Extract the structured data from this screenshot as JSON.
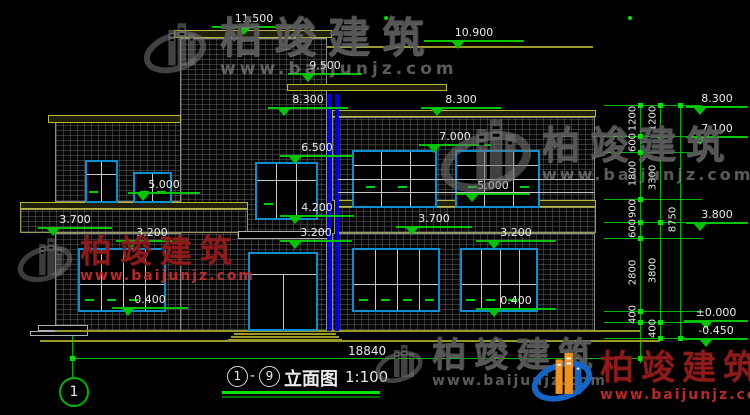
{
  "colors": {
    "background": "#000000",
    "dim_green": "#00c400",
    "frame_cyan": "#0b8fd0",
    "slab_olive": "#b8b838",
    "column_blue": "#0000e6",
    "watermark_grey": "#8a8a8a",
    "watermark_red": "#c02020",
    "text_white": "#ececec"
  },
  "watermark": {
    "brand": "柏竣建筑",
    "url": "www.baijunjz.com"
  },
  "elevations": {
    "v11500": "11.500",
    "v10900": "10.900",
    "v9500": "9.500",
    "v8300": "8.300",
    "v7100": "7.100",
    "v7000": "7.000",
    "v6500": "6.500",
    "v5000": "5.000",
    "v4200": "4.200",
    "v3800": "3.800",
    "v3700": "3.700",
    "v3200": "3.200",
    "v0400": "0.400",
    "v0000": "±0.000",
    "vm0450": "-0.450"
  },
  "dims": {
    "overall_width": "18840",
    "right_total": "8750",
    "chain_inner": [
      "1200",
      "600",
      "1800",
      "900",
      "600",
      "2800",
      "400"
    ],
    "chain_outer": [
      "1200",
      "3300",
      "3800",
      "400"
    ]
  },
  "title": {
    "axis_from": "1",
    "axis_to": "9",
    "separator": "-",
    "name": "立面图",
    "scale": "1:100"
  },
  "axis": {
    "bubble_1": "1"
  }
}
